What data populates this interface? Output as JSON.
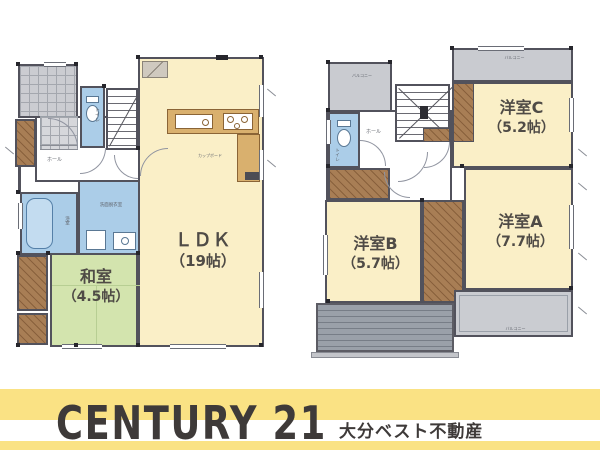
{
  "brand": {
    "logo_text": "CENTURY 21",
    "company_name": "大分ベスト不動産",
    "brand_yellow": "#FAE284",
    "logo_color": "#3E3A39"
  },
  "palette": {
    "room_cream": "#FAEFC7",
    "tatami_green": "#D3E4AE",
    "water_blue": "#ABCDE8",
    "closet_brown": "#A87E55",
    "counter_tan": "#D9B06E",
    "balcony_gray": "#C9CBD0",
    "deck_gray": "#9AA0A9",
    "wall": "#52525C",
    "label_text": "#4F4B46"
  },
  "floor1": {
    "rooms": {
      "ldk": {
        "name": "ＬＤＫ",
        "size": "（19帖）"
      },
      "washitsu": {
        "name": "和室",
        "size": "（4.5帖）"
      },
      "hall": {
        "label": "ホール"
      },
      "toilet": {
        "label": "トイレ"
      },
      "washroom": {
        "label": "洗面脱衣室"
      },
      "bath": {
        "label": "浴室"
      },
      "kitchen_cupboard": {
        "label": "カップボード"
      }
    }
  },
  "floor2": {
    "rooms": {
      "room_c": {
        "name": "洋室C",
        "size": "（5.2帖）"
      },
      "room_a": {
        "name": "洋室A",
        "size": "（7.7帖）"
      },
      "room_b": {
        "name": "洋室B",
        "size": "（5.7帖）"
      },
      "hall": {
        "label": "ホール"
      },
      "toilet": {
        "label": "トイレ"
      },
      "balcony_top_left": {
        "label": "バルコニー"
      },
      "balcony_top_right": {
        "label": "バルコニー"
      },
      "balcony_bottom_right": {
        "label": "バルコニー"
      }
    }
  }
}
